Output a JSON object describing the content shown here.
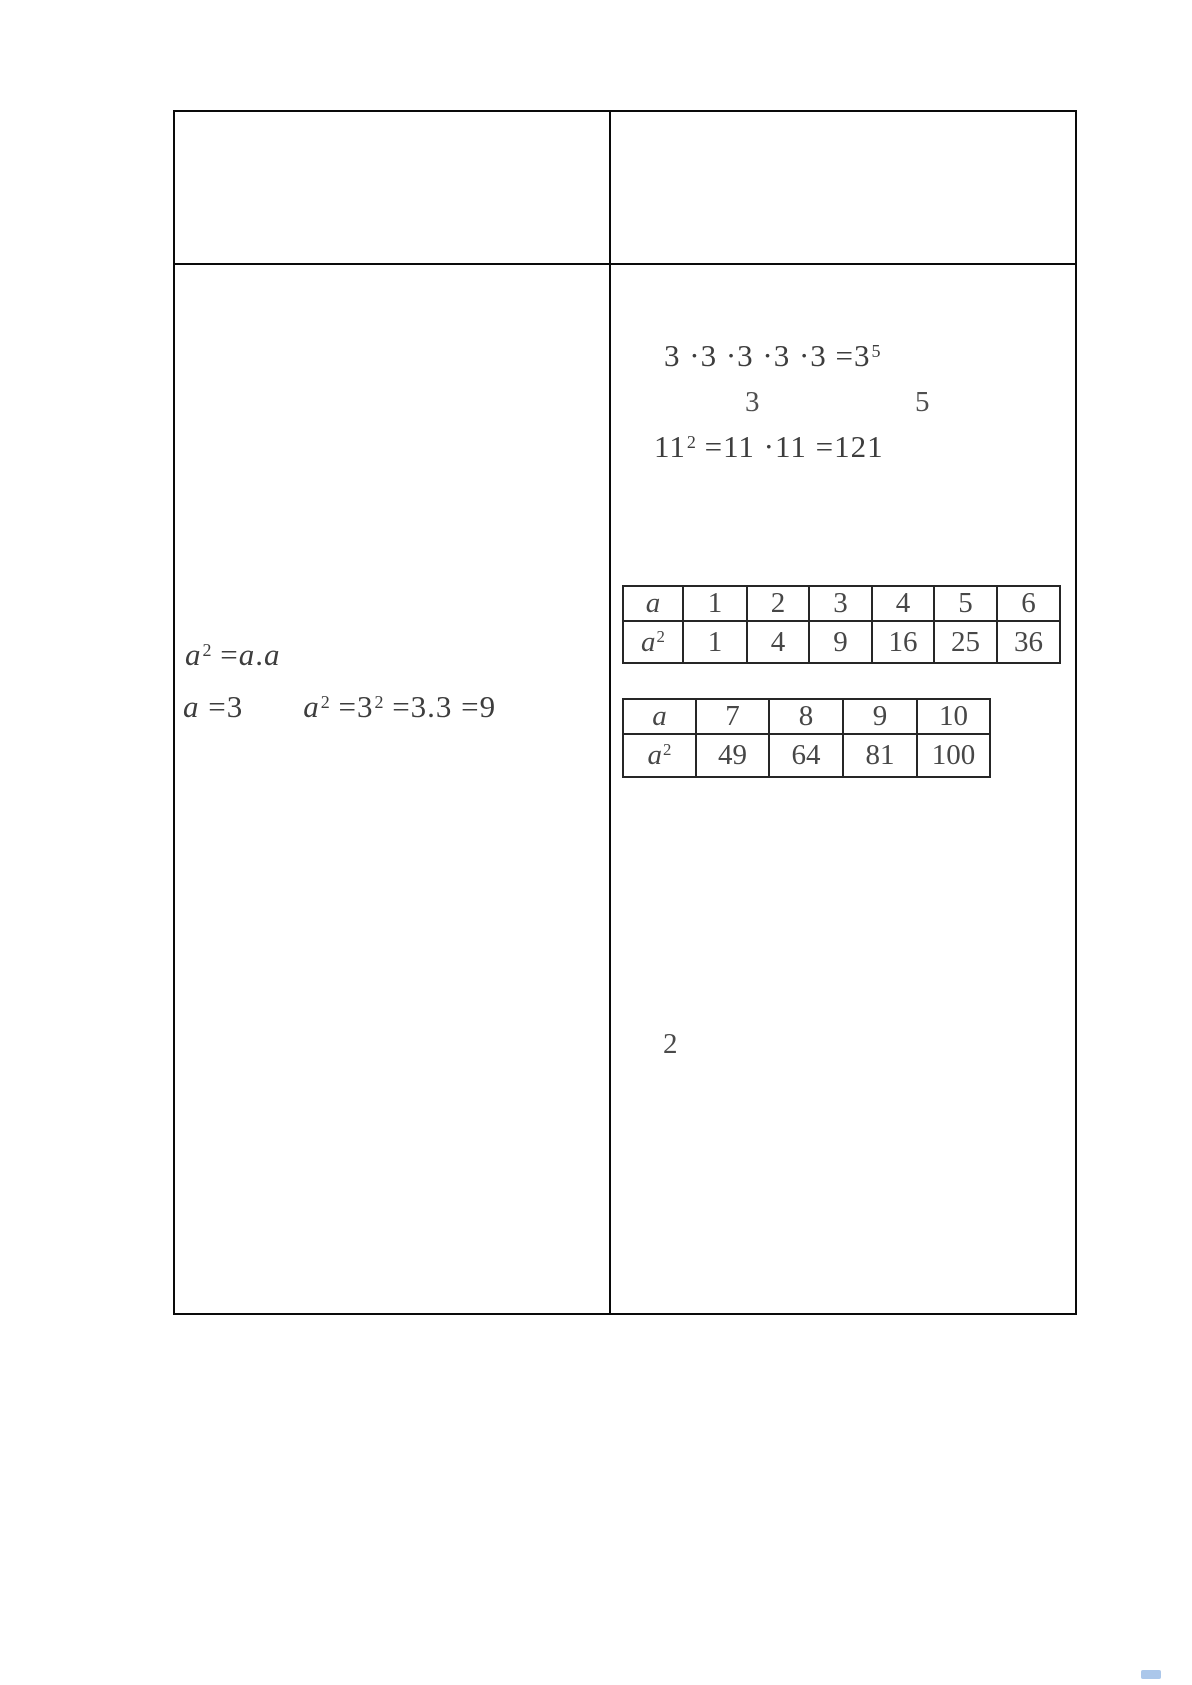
{
  "document": {
    "left_column": {
      "definition_formula": "a^2 =a.a",
      "example_value": "a =3",
      "example_expansion": "a^2 =3^2 =3.3 =9"
    },
    "right_column": {
      "power_formula": "3 ·3 ·3 ·3 ·3 =3^5",
      "base_label": "3",
      "exponent_label": "5",
      "square_example_formula": "11^2 =11 ·11 =121",
      "squares_table_1_6": {
        "rows": [
          [
            "a",
            "1",
            "2",
            "3",
            "4",
            "5",
            "6"
          ],
          [
            "a^2",
            "1",
            "4",
            "9",
            "16",
            "25",
            "36"
          ]
        ]
      },
      "squares_table_7_10": {
        "rows": [
          [
            "a",
            "7",
            "8",
            "9",
            "10"
          ],
          [
            "a^2",
            "49",
            "64",
            "81",
            "100"
          ]
        ]
      },
      "stray_number": "2"
    }
  }
}
